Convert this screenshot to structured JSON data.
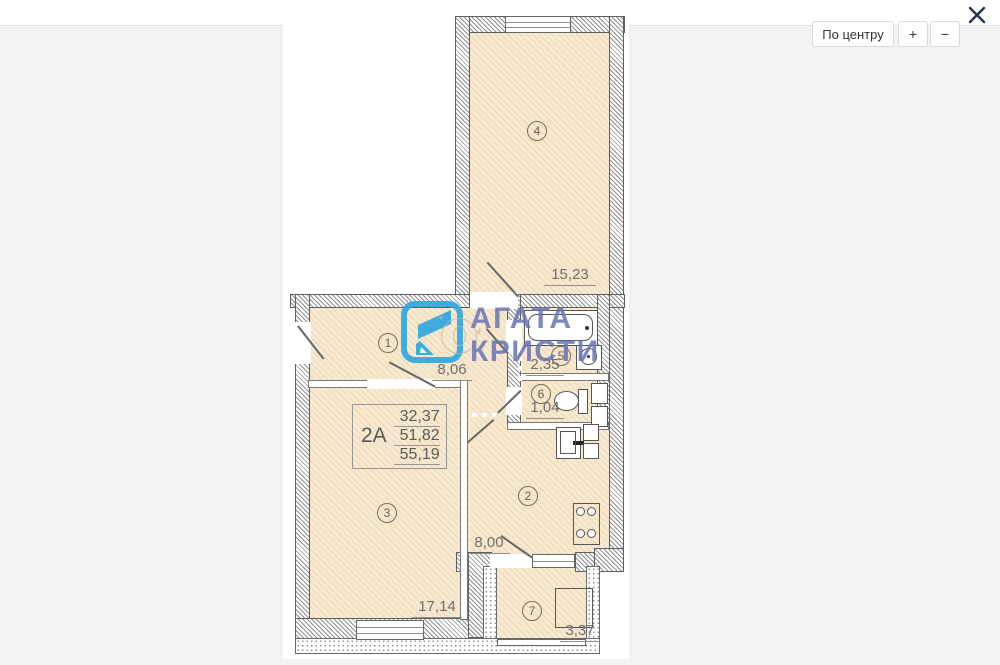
{
  "controls": {
    "center": "По центру",
    "zoom_in": "+",
    "zoom_out": "−"
  },
  "brand": {
    "line1": "АГАТА",
    "line2": "КРИСТИ"
  },
  "unit": {
    "label": "2А",
    "values": [
      "32,37",
      "51,82",
      "55,19"
    ]
  },
  "rooms": [
    {
      "num": "1",
      "area": "8,06"
    },
    {
      "num": "2",
      "area": "8,00"
    },
    {
      "num": "3",
      "area": "17,14"
    },
    {
      "num": "4",
      "area": "15,23"
    },
    {
      "num": "5",
      "area": "2,35"
    },
    {
      "num": "6",
      "area": "1,04"
    },
    {
      "num": "7",
      "area": "3,37"
    }
  ],
  "colors": {
    "accent_blue": "#2fa8df",
    "watermark_text": "#6873b5",
    "room_fill": "#f8ead2",
    "canvas_background": "#f2f2f3"
  }
}
